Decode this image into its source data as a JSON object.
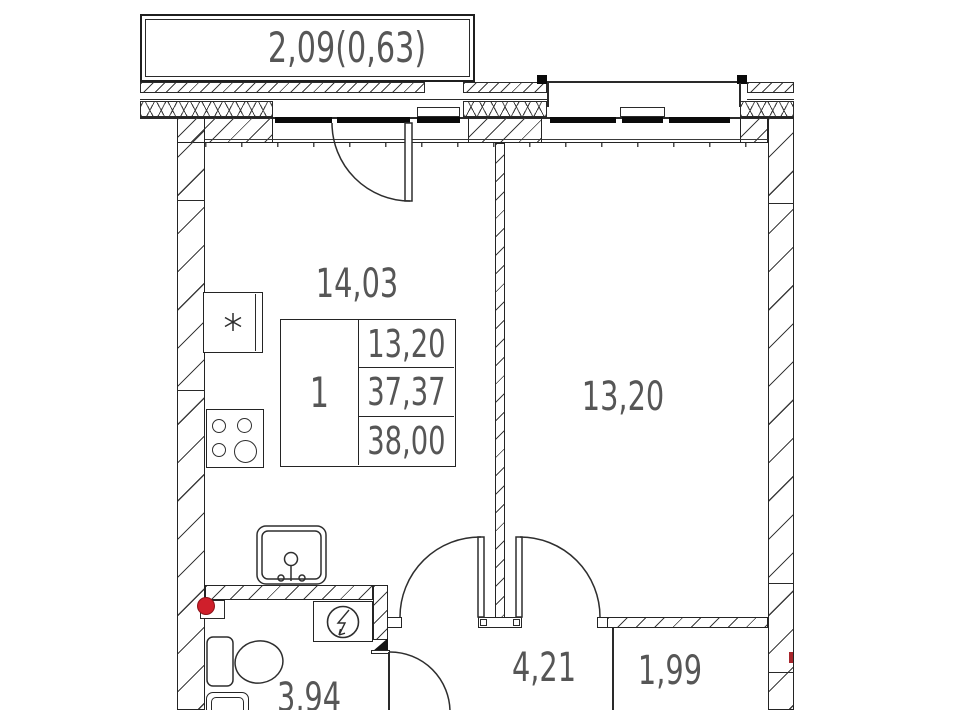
{
  "title": "one-room apartment floor plan",
  "balcony": {
    "label": "2,09(0,63)"
  },
  "rooms": {
    "kitchen": {
      "area": "14,03"
    },
    "living_room": {
      "area": "13,20"
    },
    "hallway": {
      "area": "4,21"
    },
    "storage": {
      "area": "1,99"
    },
    "bathroom": {
      "area": "3,94"
    }
  },
  "stamp": {
    "apartment_number": "1",
    "living_area": "13,20",
    "area_without_balcony": "37,37",
    "total_area": "38,00"
  },
  "icons": {
    "fridge": "asterisk-star",
    "stove": "four-burner-rings",
    "sink": "basin-with-faucet",
    "toilet": "cistern-and-bowl",
    "electric_meter": "circle-with-lightning-arrow",
    "riser_marker": "red-filled-circle",
    "right_wall_marker": "red-tick"
  },
  "colors": {
    "lines": "#2a2a2a",
    "hatch": "#3c3c3c",
    "text": "#565656",
    "window_glazing": "#0a0a0a",
    "riser_red": "#cf1f2b",
    "background": "#ffffff"
  }
}
